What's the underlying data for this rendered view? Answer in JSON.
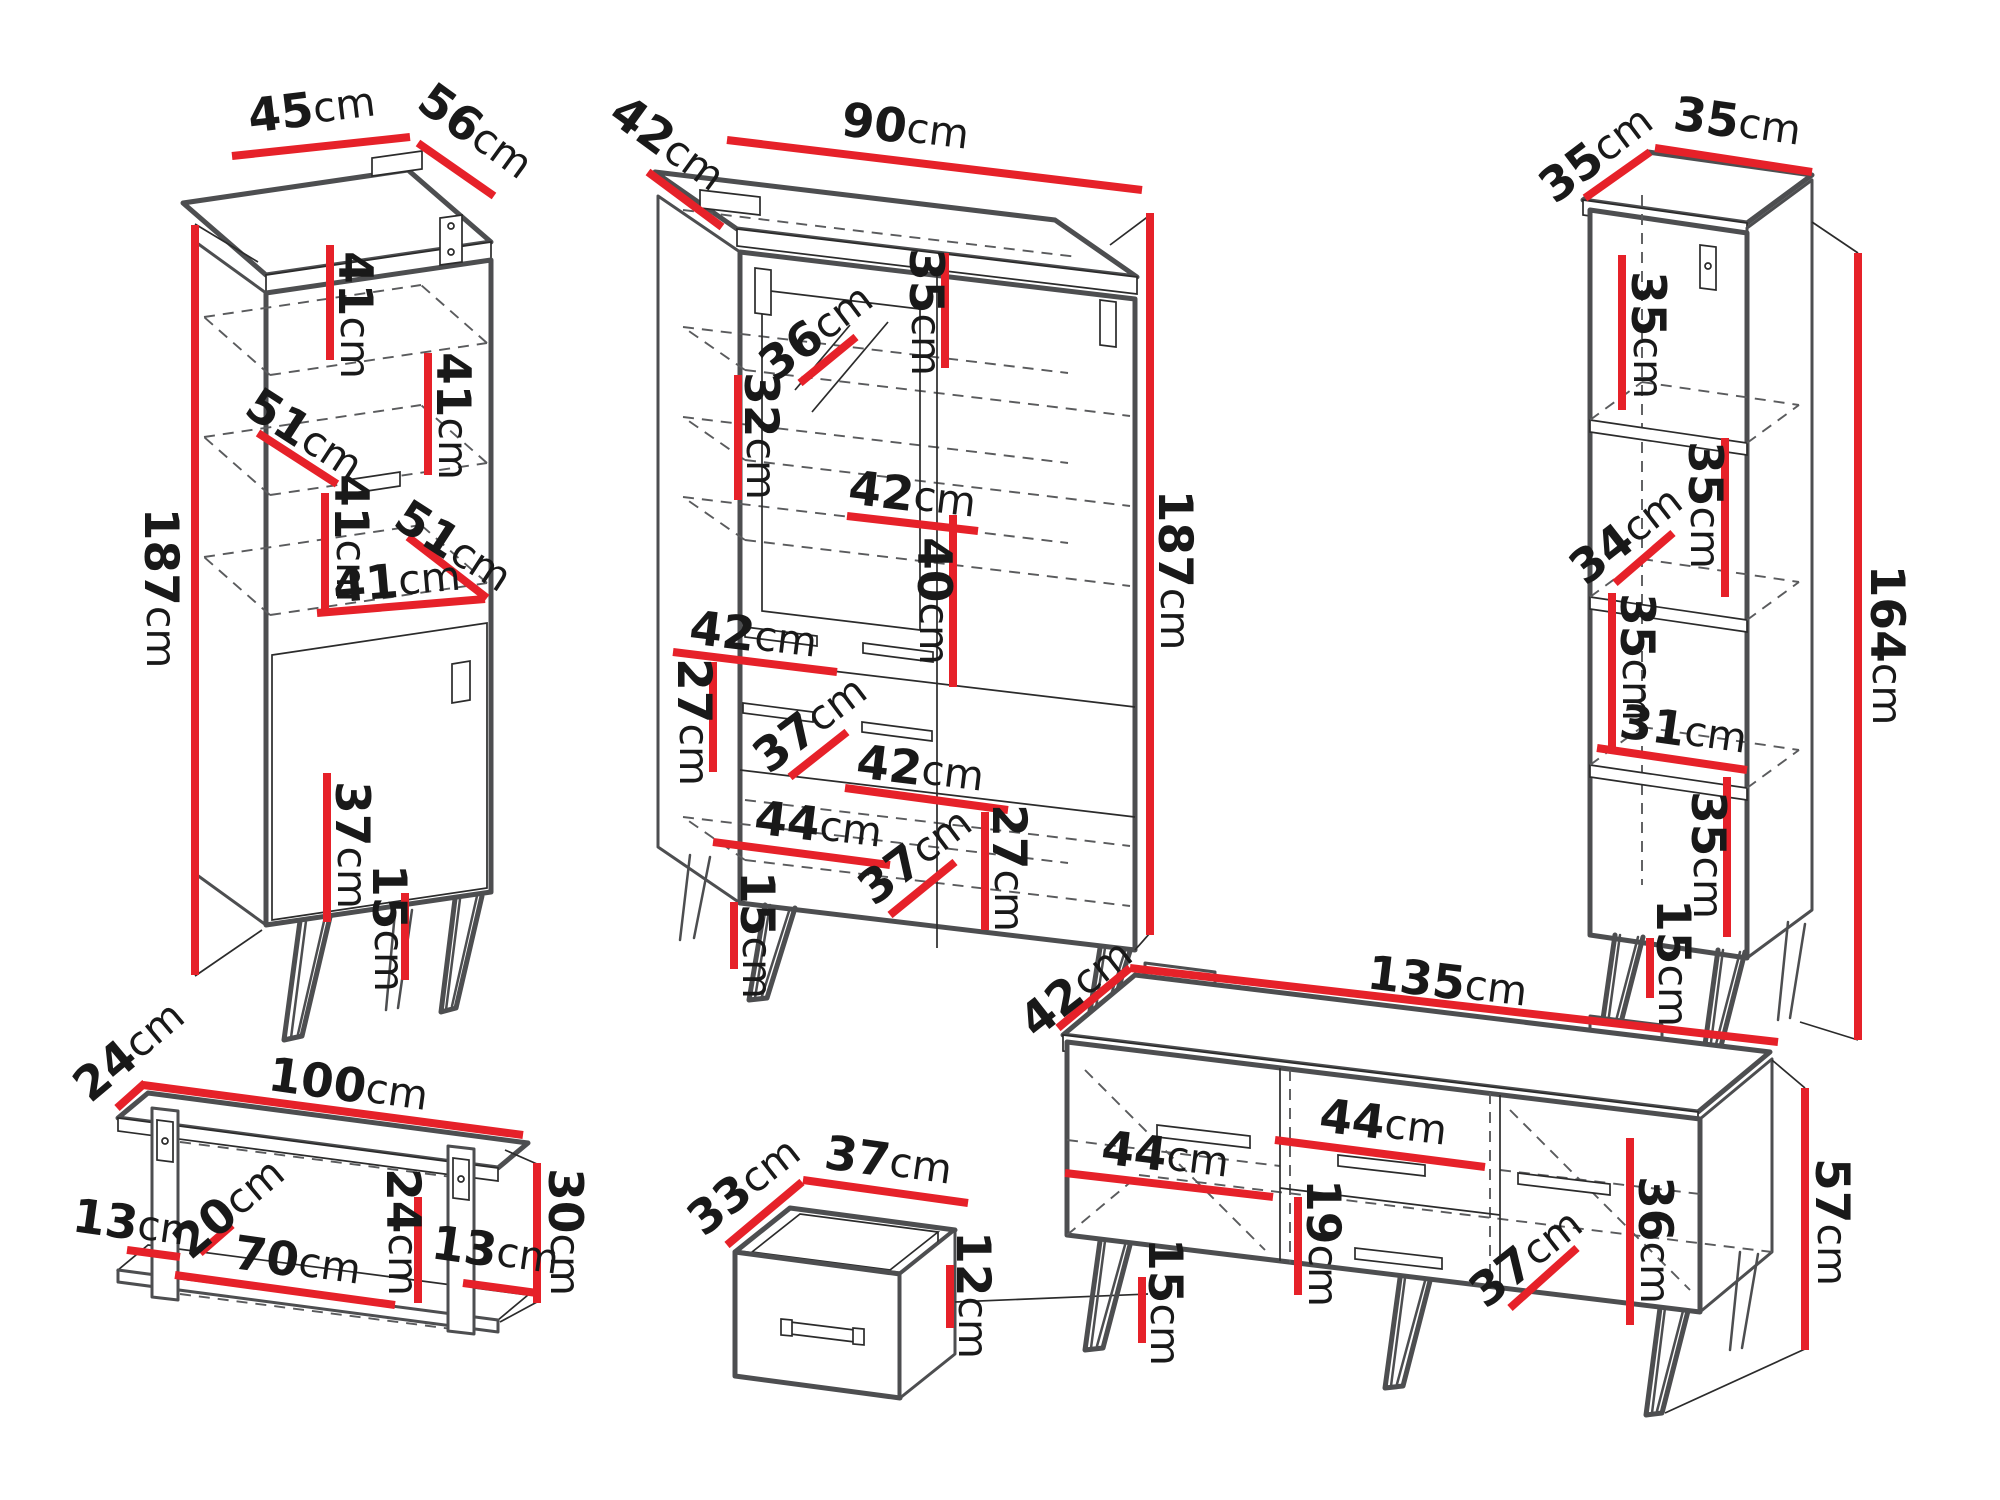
{
  "diagram": {
    "title": "furniture-set-dimension-drawing",
    "unit": "cm",
    "colors": {
      "dimension_red": "#e62129",
      "outline_gray": "#4d4e50",
      "line_dark": "#2b2b2b",
      "background": "#ffffff"
    }
  },
  "pieces": {
    "p1": {
      "id": "tall-cabinet",
      "labels": {
        "width": {
          "n": "45",
          "u": "cm"
        },
        "depth": {
          "n": "56",
          "u": "cm"
        },
        "height": {
          "n": "187",
          "u": "cm"
        },
        "shelf1": {
          "n": "41",
          "u": "cm"
        },
        "shelf2": {
          "n": "41",
          "u": "cm"
        },
        "diag1": {
          "n": "51",
          "u": "cm"
        },
        "shelf3": {
          "n": "41",
          "u": "cm"
        },
        "diag2": {
          "n": "51",
          "u": "cm"
        },
        "shelf4": {
          "n": "41",
          "u": "cm"
        },
        "door": {
          "n": "37",
          "u": "cm"
        },
        "legs": {
          "n": "15",
          "u": "cm"
        }
      }
    },
    "p2": {
      "id": "display-cabinet",
      "labels": {
        "depth": {
          "n": "42",
          "u": "cm"
        },
        "width": {
          "n": "90",
          "u": "cm"
        },
        "height": {
          "n": "187",
          "u": "cm"
        },
        "glass_diag": {
          "n": "36",
          "u": "cm"
        },
        "shelf_top": {
          "n": "35",
          "u": "cm"
        },
        "glass_h": {
          "n": "32",
          "u": "cm"
        },
        "shelf_right": {
          "n": "42",
          "u": "cm"
        },
        "inner_h": {
          "n": "40",
          "u": "cm"
        },
        "shelf_left": {
          "n": "42",
          "u": "cm"
        },
        "left_h": {
          "n": "27",
          "u": "cm"
        },
        "drawer_w": {
          "n": "37",
          "u": "cm"
        },
        "shelf_right2": {
          "n": "42",
          "u": "cm"
        },
        "bottom_w": {
          "n": "44",
          "u": "cm"
        },
        "bottom_diag": {
          "n": "37",
          "u": "cm"
        },
        "right_h": {
          "n": "27",
          "u": "cm"
        },
        "legs": {
          "n": "15",
          "u": "cm"
        }
      }
    },
    "p3": {
      "id": "shelf-unit",
      "labels": {
        "depth": {
          "n": "35",
          "u": "cm"
        },
        "width": {
          "n": "35",
          "u": "cm"
        },
        "height": {
          "n": "164",
          "u": "cm"
        },
        "shelf1": {
          "n": "35",
          "u": "cm"
        },
        "diag": {
          "n": "34",
          "u": "cm"
        },
        "shelf2": {
          "n": "35",
          "u": "cm"
        },
        "shelf3": {
          "n": "35",
          "u": "cm"
        },
        "shelf4": {
          "n": "31",
          "u": "cm"
        },
        "shelf5": {
          "n": "35",
          "u": "cm"
        },
        "legs": {
          "n": "15",
          "u": "cm"
        }
      }
    },
    "p4": {
      "id": "wall-shelf",
      "labels": {
        "depth": {
          "n": "24",
          "u": "cm"
        },
        "width": {
          "n": "100",
          "u": "cm"
        },
        "height": {
          "n": "30",
          "u": "cm"
        },
        "left": {
          "n": "13",
          "u": "cm"
        },
        "diag": {
          "n": "20",
          "u": "cm"
        },
        "bottom": {
          "n": "70",
          "u": "cm"
        },
        "inner": {
          "n": "24",
          "u": "cm"
        },
        "right": {
          "n": "13",
          "u": "cm"
        }
      }
    },
    "p5": {
      "id": "drawer-box",
      "labels": {
        "depth": {
          "n": "33",
          "u": "cm"
        },
        "width": {
          "n": "37",
          "u": "cm"
        },
        "height": {
          "n": "12",
          "u": "cm"
        }
      }
    },
    "p6": {
      "id": "tv-stand",
      "labels": {
        "depth": {
          "n": "42",
          "u": "cm"
        },
        "width": {
          "n": "135",
          "u": "cm"
        },
        "height": {
          "n": "57",
          "u": "cm"
        },
        "left_shelf": {
          "n": "44",
          "u": "cm"
        },
        "right_shelf": {
          "n": "44",
          "u": "cm"
        },
        "drawer": {
          "n": "19",
          "u": "cm"
        },
        "legs": {
          "n": "15",
          "u": "cm"
        },
        "door": {
          "n": "36",
          "u": "cm"
        },
        "diag": {
          "n": "37",
          "u": "cm"
        }
      }
    }
  }
}
